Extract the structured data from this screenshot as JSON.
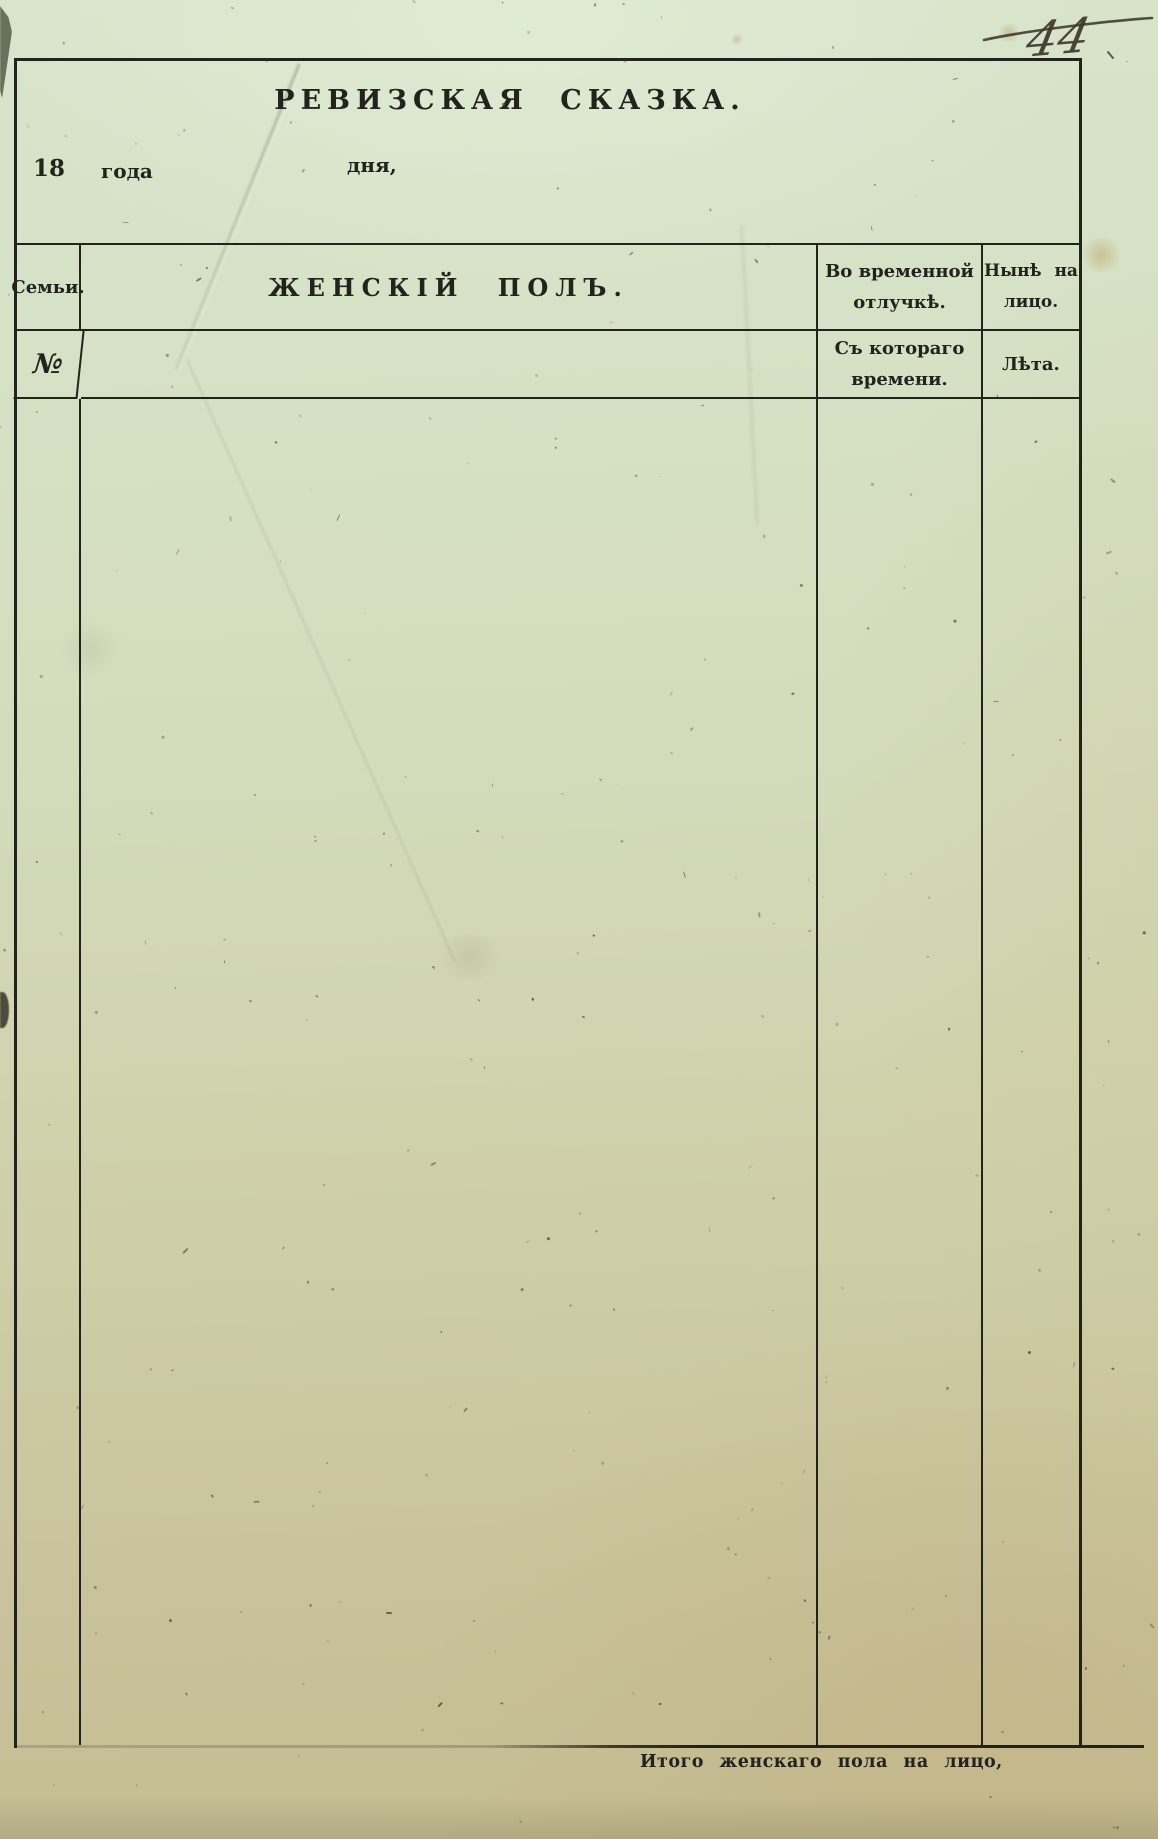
{
  "page": {
    "handwritten_page_number": "44"
  },
  "form": {
    "title": "РЕВИЗСКАЯ СКАЗКА.",
    "date_line": {
      "century": "18",
      "year_word": "года",
      "day_word": "дня,"
    },
    "table": {
      "header_row1": {
        "family_col": "Семьи.",
        "main_col": "ЖЕНСКІЙ ПОЛЪ.",
        "absence_line1": "Во временной",
        "absence_line2": "отлучкѣ.",
        "present_line1": "Нынѣ на",
        "present_line2": "лицо."
      },
      "header_row2": {
        "number_symbol": "№",
        "since_line1": "Съ котораго",
        "since_line2": "времени.",
        "age_col": "Лѣта."
      }
    },
    "footer_caption": "Итого женскаго пола на лицо,"
  },
  "colors": {
    "ink": "#23231e",
    "paper_top": "#d8e4cb",
    "paper_bottom": "#c5bd93"
  }
}
